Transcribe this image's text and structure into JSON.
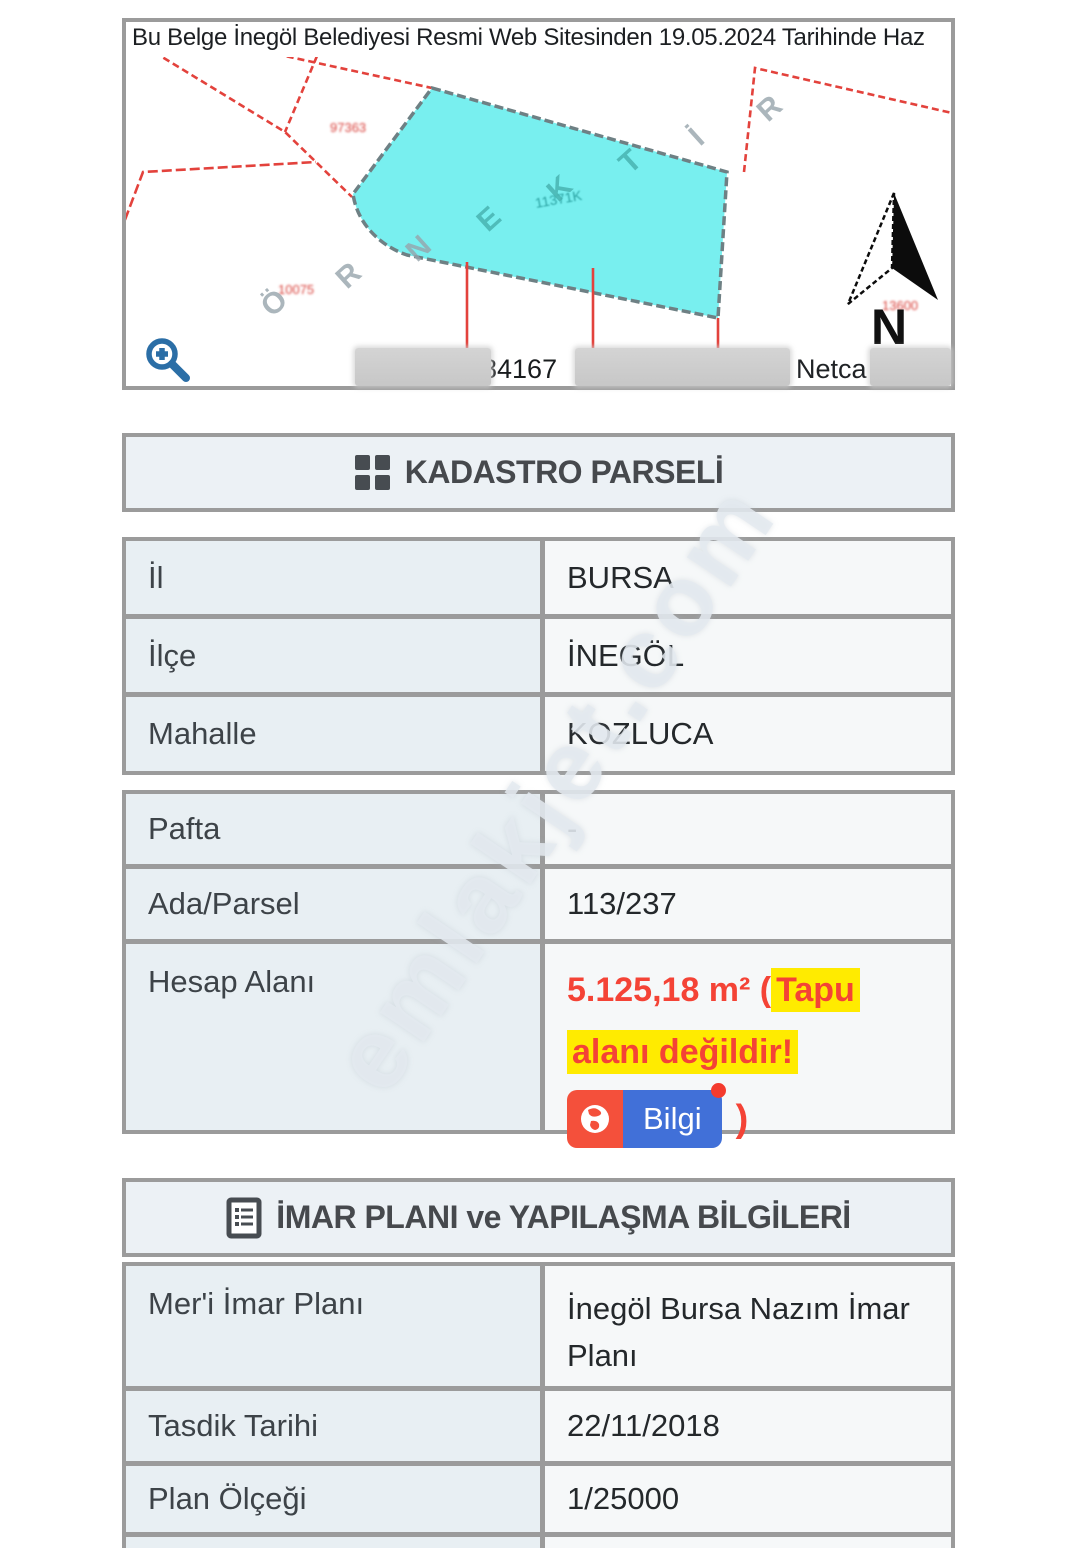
{
  "banner": {
    "text": "Bu Belge İnegöl Belediyesi Resmi Web Sitesinden 19.05.2024 Tarihinde Haz"
  },
  "map": {
    "number_label": "84167",
    "provider_label": "Netca",
    "north_label": "N",
    "sample_letters": [
      "Ö",
      "R",
      "N",
      "E",
      "K",
      "T",
      "İ",
      "R"
    ],
    "tiny_labels": {
      "upper": "97363",
      "lower": "10075",
      "parcel": "11371K",
      "near_north": "13600"
    }
  },
  "sections": {
    "kadastro_title": "KADASTRO PARSELİ",
    "imar_title": "İMAR PLANI ve YAPILAŞMA BİLGİLERİ"
  },
  "location_table": {
    "rows": [
      {
        "label": "İl",
        "value": "BURSA"
      },
      {
        "label": "İlçe",
        "value": "İNEGÖL"
      },
      {
        "label": "Mahalle",
        "value": "KOZLUCA"
      }
    ]
  },
  "parcel_table": {
    "rows": [
      {
        "label": "Pafta",
        "value": "-"
      },
      {
        "label": "Ada/Parsel",
        "value": "113/237"
      }
    ],
    "hesap": {
      "label": "Hesap Alanı",
      "prefix": "5.125,18 m² (",
      "highlight_line1": "Tapu",
      "highlight_line2": "alanı değildir!",
      "button_label": "Bilgi",
      "suffix": ")"
    }
  },
  "imar_table": {
    "rows": [
      {
        "label": "Mer'i İmar Planı",
        "value": "İnegöl Bursa Nazım İmar Planı"
      },
      {
        "label": "Tasdik Tarihi",
        "value": "22/11/2018"
      },
      {
        "label": "Plan Ölçeği",
        "value": "1/25000"
      }
    ]
  },
  "watermark": {
    "text": "emlakjet.com"
  },
  "colors": {
    "accent_red": "#f44336",
    "highlight_yellow": "#ffeb00",
    "badge_red": "#f4503b",
    "badge_blue": "#4170d8",
    "zoom_icon_blue": "#2b6ea6",
    "parcel_cyan": "#78efef",
    "map_line_red": "#e3423c",
    "border_gray": "#9b9b9b"
  }
}
